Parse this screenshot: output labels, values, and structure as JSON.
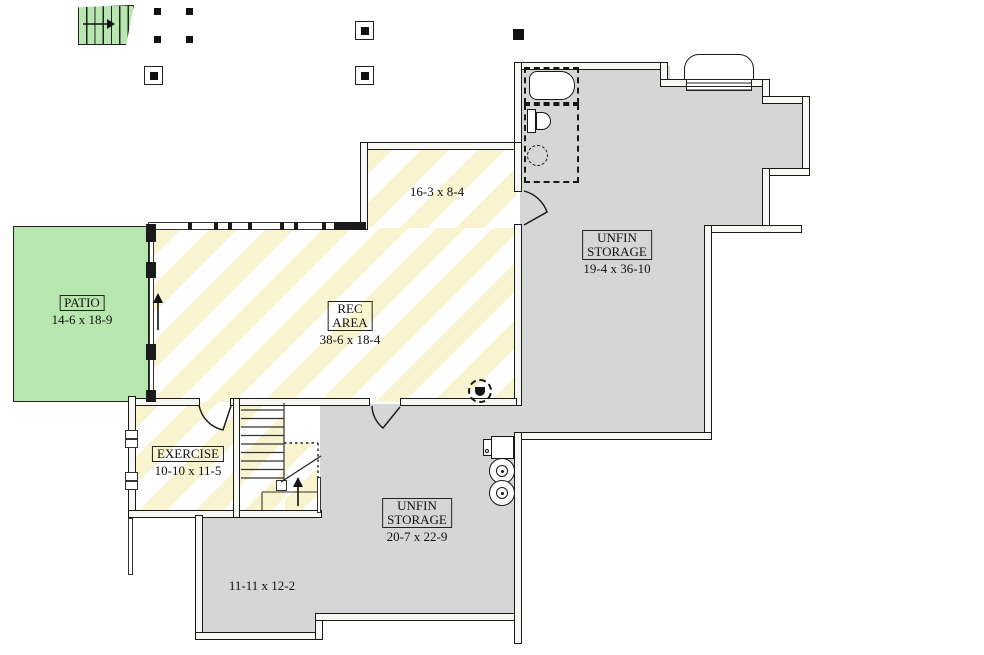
{
  "plan": {
    "rooms": {
      "patio": {
        "label": "PATIO",
        "dims": "14-6 x 18-9"
      },
      "rec_area": {
        "label_line1": "REC",
        "label_line2": "AREA",
        "dims": "38-6 x 18-4"
      },
      "rec_alcove": {
        "dims": "16-3 x 8-4"
      },
      "exercise": {
        "label": "EXERCISE",
        "dims": "10-10 x 11-5"
      },
      "storage_upper": {
        "label_line1": "UNFIN",
        "label_line2": "STORAGE",
        "dims": "19-4 x 36-10"
      },
      "storage_lower": {
        "label_line1": "UNFIN",
        "label_line2": "STORAGE",
        "dims": "20-7 x 22-9"
      },
      "storage_nook": {
        "dims": "11-11 x 12-2"
      }
    },
    "colors": {
      "unfinished_gray": "#d6d6d6",
      "stripe_yellow": "#faf3cf",
      "patio_green": "#b7e7ae",
      "wall_line": "#1a1a1a"
    },
    "icons": [
      "stairs-up-icon",
      "column-post-icon",
      "post-footing-icon",
      "window-well-icon",
      "bathtub-icon",
      "toilet-icon",
      "sink-icon",
      "furnace-icon",
      "water-heater-icon",
      "floor-drain-icon",
      "door-swing-icon",
      "up-arrow-icon",
      "window-icon"
    ]
  }
}
